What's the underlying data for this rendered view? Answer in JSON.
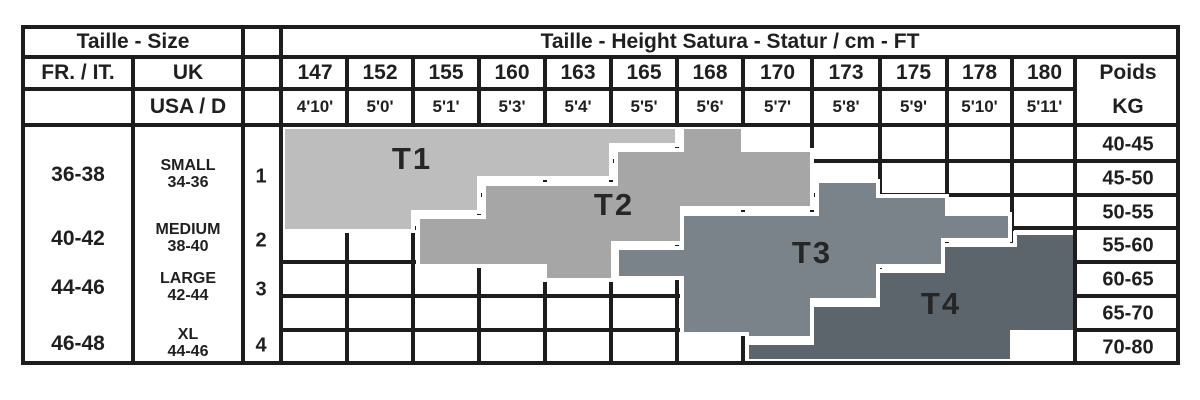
{
  "header": {
    "size_title": "Taille - Size",
    "height_title": "Taille - Height Satura - Statur / cm - FT",
    "fr_it_label": "FR. / IT.",
    "uk_label": "UK",
    "usa_d_label": "USA / D",
    "weight_label_line1": "Poids",
    "weight_label_line2": "KG"
  },
  "columns": {
    "heights_cm": [
      "147",
      "152",
      "155",
      "160",
      "163",
      "165",
      "168",
      "170",
      "173",
      "175",
      "178",
      "180"
    ],
    "heights_ft": [
      "4'10'",
      "5'0'",
      "5'1'",
      "5'3'",
      "5'4'",
      "5'5'",
      "5'6'",
      "5'7'",
      "5'8'",
      "5'9'",
      "5'10'",
      "5'11'"
    ]
  },
  "weights_kg": [
    "40-45",
    "45-50",
    "50-55",
    "55-60",
    "60-65",
    "65-70",
    "70-80"
  ],
  "size_rows": [
    {
      "fr_it": "36-38",
      "uk_name": "SMALL",
      "uk_range": "34-36",
      "index": "1"
    },
    {
      "fr_it": "40-42",
      "uk_name": "MEDIUM",
      "uk_range": "38-40",
      "index": "2"
    },
    {
      "fr_it": "44-46",
      "uk_name": "LARGE",
      "uk_range": "42-44",
      "index": "3"
    },
    {
      "fr_it": "46-48",
      "uk_name": "XL",
      "uk_range": "44-46",
      "index": "4"
    }
  ],
  "colors": {
    "grid": "#1d1d1d",
    "text": "#1f1f1f",
    "zone_label": "#262626",
    "t1": "#bdbdbd",
    "t2": "#a6a6a6",
    "t3": "#7a838a",
    "t4": "#5d656c"
  },
  "chart_data": {
    "type": "heatmap",
    "title": "Taille - Height Satura - Statur / cm - FT",
    "x_axis": {
      "label": "height",
      "units": [
        "cm",
        "ft"
      ],
      "ticks_cm": [
        147,
        152,
        155,
        160,
        163,
        165,
        168,
        170,
        173,
        175,
        178,
        180
      ]
    },
    "y_axis": {
      "label": "Poids KG",
      "tick_ranges": [
        "40-45",
        "45-50",
        "50-55",
        "55-60",
        "60-65",
        "65-70",
        "70-80"
      ]
    },
    "legend": "zones map height (cm/ft) and weight (kg) to hosiery sizes T1-T4",
    "zones": [
      {
        "label": "T1",
        "size_fr_it": "36-38",
        "size_uk": "SMALL 34-36",
        "approx_height_cm": "147-165",
        "approx_weight_kg": "40-55",
        "color": "#bdbdbd",
        "label_pos": [
          412,
          158
        ],
        "points": [
          [
            283,
            127
          ],
          [
            677,
            127
          ],
          [
            677,
            145
          ],
          [
            611,
            145
          ],
          [
            611,
            178
          ],
          [
            479,
            178
          ],
          [
            479,
            212
          ],
          [
            413,
            212
          ],
          [
            413,
            231
          ],
          [
            283,
            231
          ]
        ]
      },
      {
        "label": "T2",
        "size_fr_it": "40-42",
        "size_uk": "MEDIUM 38-40",
        "approx_height_cm": "155-170",
        "approx_weight_kg": "40-60",
        "color": "#a6a6a6",
        "label_pos": [
          614,
          204
        ],
        "points": [
          [
            418,
            217
          ],
          [
            484,
            217
          ],
          [
            484,
            184
          ],
          [
            616,
            184
          ],
          [
            616,
            150
          ],
          [
            682,
            150
          ],
          [
            682,
            127
          ],
          [
            743,
            127
          ],
          [
            743,
            150
          ],
          [
            812,
            150
          ],
          [
            812,
            208
          ],
          [
            682,
            208
          ],
          [
            682,
            243
          ],
          [
            613,
            243
          ],
          [
            613,
            280
          ],
          [
            545,
            280
          ],
          [
            545,
            266
          ],
          [
            418,
            266
          ]
        ]
      },
      {
        "label": "T3",
        "size_fr_it": "44-46",
        "size_uk": "LARGE 42-44",
        "approx_height_cm": "163-178",
        "approx_weight_kg": "45-70",
        "color": "#7a838a",
        "label_pos": [
          812,
          252
        ],
        "points": [
          [
            617,
            248
          ],
          [
            682,
            248
          ],
          [
            682,
            214
          ],
          [
            817,
            214
          ],
          [
            817,
            181
          ],
          [
            878,
            181
          ],
          [
            878,
            196
          ],
          [
            947,
            196
          ],
          [
            947,
            214
          ],
          [
            1010,
            214
          ],
          [
            1010,
            240
          ],
          [
            943,
            240
          ],
          [
            943,
            266
          ],
          [
            878,
            266
          ],
          [
            878,
            300
          ],
          [
            812,
            300
          ],
          [
            812,
            338
          ],
          [
            747,
            338
          ],
          [
            747,
            334
          ],
          [
            682,
            334
          ],
          [
            682,
            278
          ],
          [
            617,
            278
          ]
        ]
      },
      {
        "label": "T4",
        "size_fr_it": "46-48",
        "size_uk": "XL 44-46",
        "approx_height_cm": "168-180",
        "approx_weight_kg": "55-80",
        "color": "#5d656c",
        "label_pos": [
          941,
          303
        ],
        "points": [
          [
            747,
            343
          ],
          [
            812,
            343
          ],
          [
            812,
            305
          ],
          [
            878,
            305
          ],
          [
            878,
            271
          ],
          [
            943,
            271
          ],
          [
            943,
            245
          ],
          [
            1015,
            245
          ],
          [
            1015,
            233
          ],
          [
            1075,
            233
          ],
          [
            1075,
            332
          ],
          [
            1012,
            332
          ],
          [
            1012,
            361
          ],
          [
            747,
            361
          ]
        ]
      }
    ]
  }
}
